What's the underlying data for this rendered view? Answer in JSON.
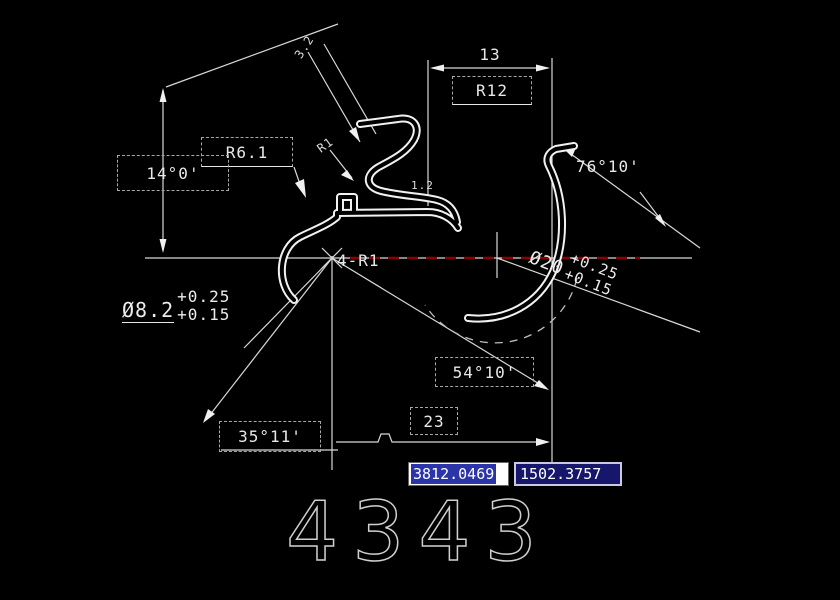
{
  "drawing": {
    "labels": {
      "dim_top_13": "13",
      "r12": "R12",
      "r61": "R6.1",
      "angle_14": "14°0'",
      "angle_76": "76°10'",
      "angle_54": "54°10'",
      "angle_35": "35°11'",
      "dim_bottom_23": "23",
      "fillet_4r1": "4-R1",
      "small_dim_32": "3.2",
      "small_r1": "R1",
      "small_dim_12": "1.2",
      "dia_8_2": {
        "value": "Ø8.2",
        "tol_upper": "+0.25",
        "tol_lower": "+0.15"
      },
      "dia_20": {
        "value": "Ø20",
        "tol_upper": "+0.25",
        "tol_lower": "+0.15"
      }
    },
    "drawing_number": "4343",
    "colors": {
      "background": "#000000",
      "geometry": "#ffffff",
      "centerline_highlight": "#8b0000",
      "dim_text": "#e8e8e8"
    }
  },
  "coordinate_readout": {
    "x": {
      "value": "3812.0469",
      "selected": true
    },
    "y": {
      "value": "1502.3757",
      "selected": false
    },
    "selection_color": "#2b35a8",
    "field_bg": "#16166b"
  }
}
